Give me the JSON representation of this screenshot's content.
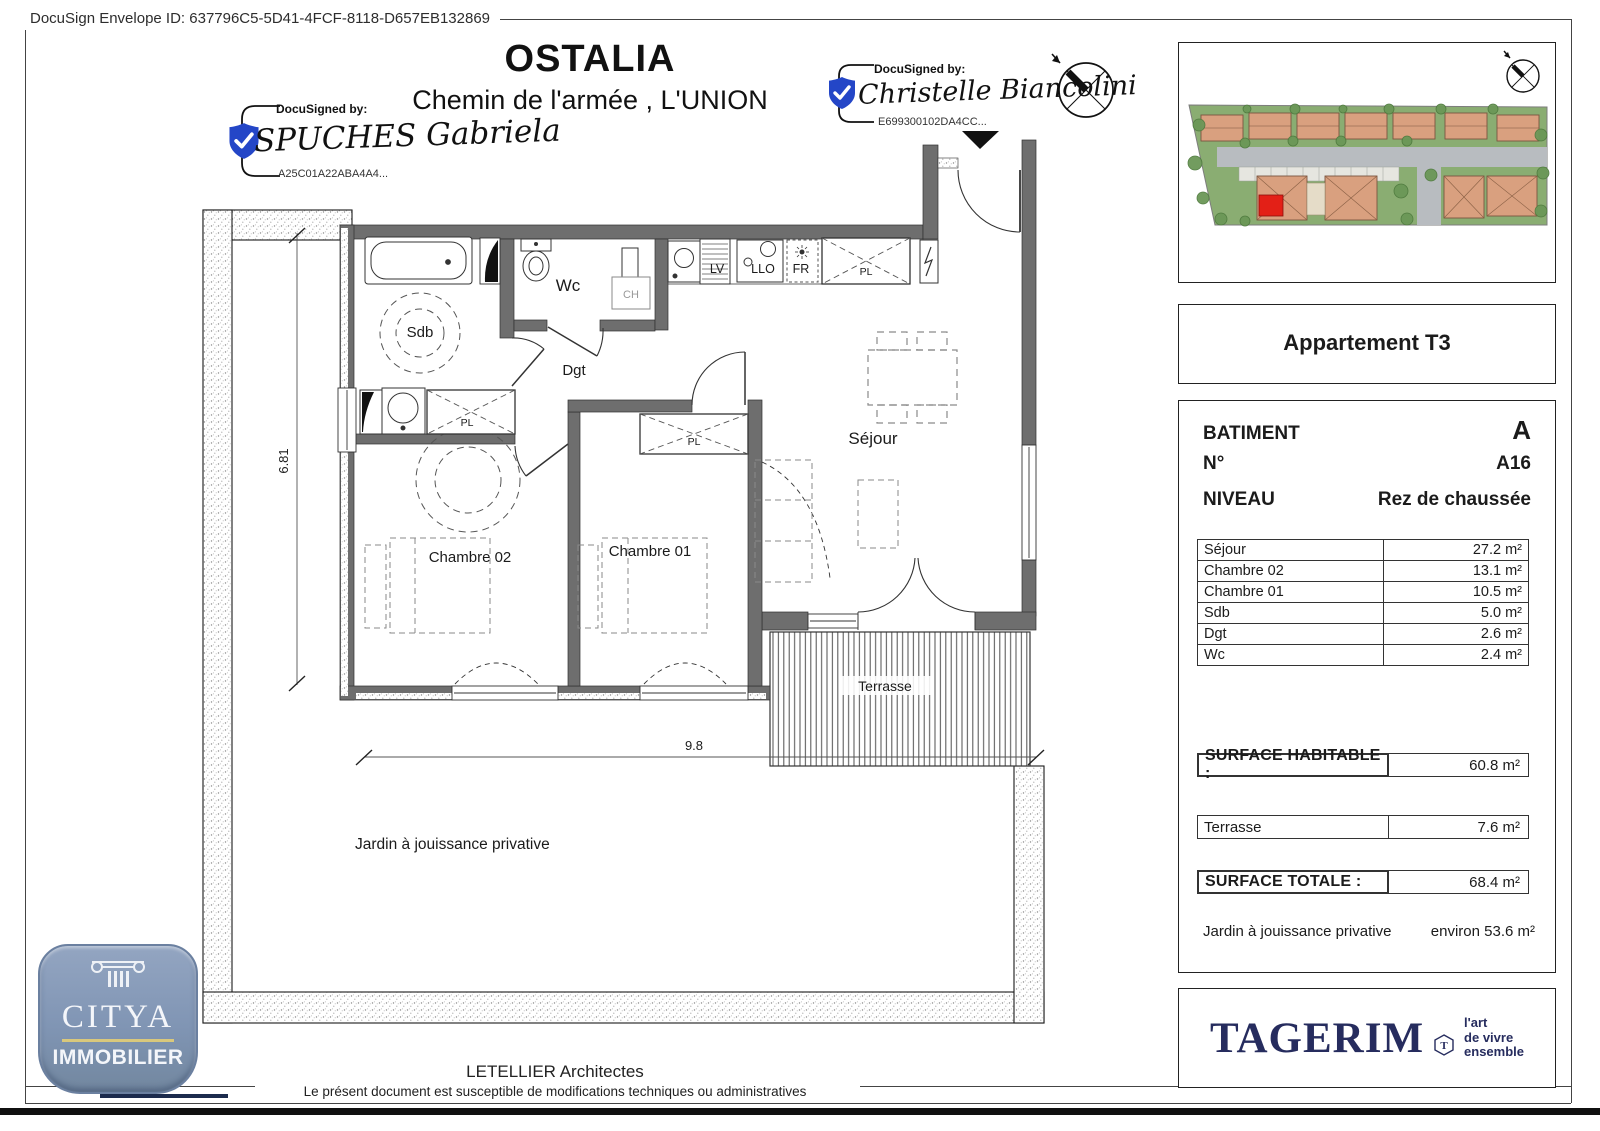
{
  "page": {
    "envelope_id": "DocuSign Envelope ID: 637796C5-5D41-4FCF-8118-D657EB132869",
    "title": "OSTALIA",
    "subtitle": "Chemin de l'armée , L'UNION"
  },
  "signatures": {
    "label": "DocuSigned by:",
    "sig1": {
      "name": "SPUCHES Gabriela",
      "id": "A25C01A22ABA4A4..."
    },
    "sig2": {
      "name": "Christelle Biancolini",
      "id": "E699300102DA4CC..."
    }
  },
  "plan": {
    "rooms": {
      "sdb": "Sdb",
      "wc": "Wc",
      "dgt": "Dgt",
      "sejour": "Séjour",
      "chambre02": "Chambre 02",
      "chambre01": "Chambre 01",
      "terrasse": "Terrasse"
    },
    "fixtures": {
      "pl": "PL",
      "lv": "LV",
      "llo": "LLO",
      "fr": "FR",
      "ch": "CH"
    },
    "dims": {
      "height": "6.81",
      "width": "9.8"
    },
    "jardin_label": "Jardin à jouissance privative"
  },
  "panel": {
    "apartment_title": "Appartement T3",
    "batiment_label": "BATIMENT",
    "batiment_value": "A",
    "numero_label": "N°",
    "numero_value": "A16",
    "niveau_label": "NIVEAU",
    "niveau_value": "Rez de chaussée",
    "room_table": [
      {
        "label": "Séjour",
        "value": "27.2 m²"
      },
      {
        "label": "Chambre 02",
        "value": "13.1 m²"
      },
      {
        "label": "Chambre 01",
        "value": "10.5 m²"
      },
      {
        "label": "Sdb",
        "value": "5.0 m²"
      },
      {
        "label": "Dgt",
        "value": "2.6 m²"
      },
      {
        "label": "Wc",
        "value": "2.4 m²"
      }
    ],
    "surface_habitable": {
      "label": "SURFACE HABITABLE :",
      "value": "60.8 m²"
    },
    "terrasse_row": {
      "label": "Terrasse",
      "value": "7.6 m²"
    },
    "surface_totale": {
      "label": "SURFACE TOTALE :",
      "value": "68.4 m²"
    },
    "jardin_row": {
      "label": "Jardin à jouissance privative",
      "value": "environ 53.6 m²"
    }
  },
  "branding": {
    "citya": {
      "name": "CITYA",
      "subtitle": "IMMOBILIER"
    },
    "tagerim": {
      "name": "TAGERIM",
      "tagline1": "l'art",
      "tagline2": "de vivre",
      "tagline3": "ensemble"
    }
  },
  "footer": {
    "architect": "LETELLIER Architectes",
    "disclaimer": "Le présent document est susceptible de modifications techniques ou administratives"
  },
  "colors": {
    "docusign_blue": "#2446c7",
    "tagerim_navy": "#262c5e",
    "citya_slate": "#8095b4",
    "citya_gold": "#d9c87c",
    "highlight_red": "#e32017",
    "wall_gray": "#6e6e6e"
  }
}
